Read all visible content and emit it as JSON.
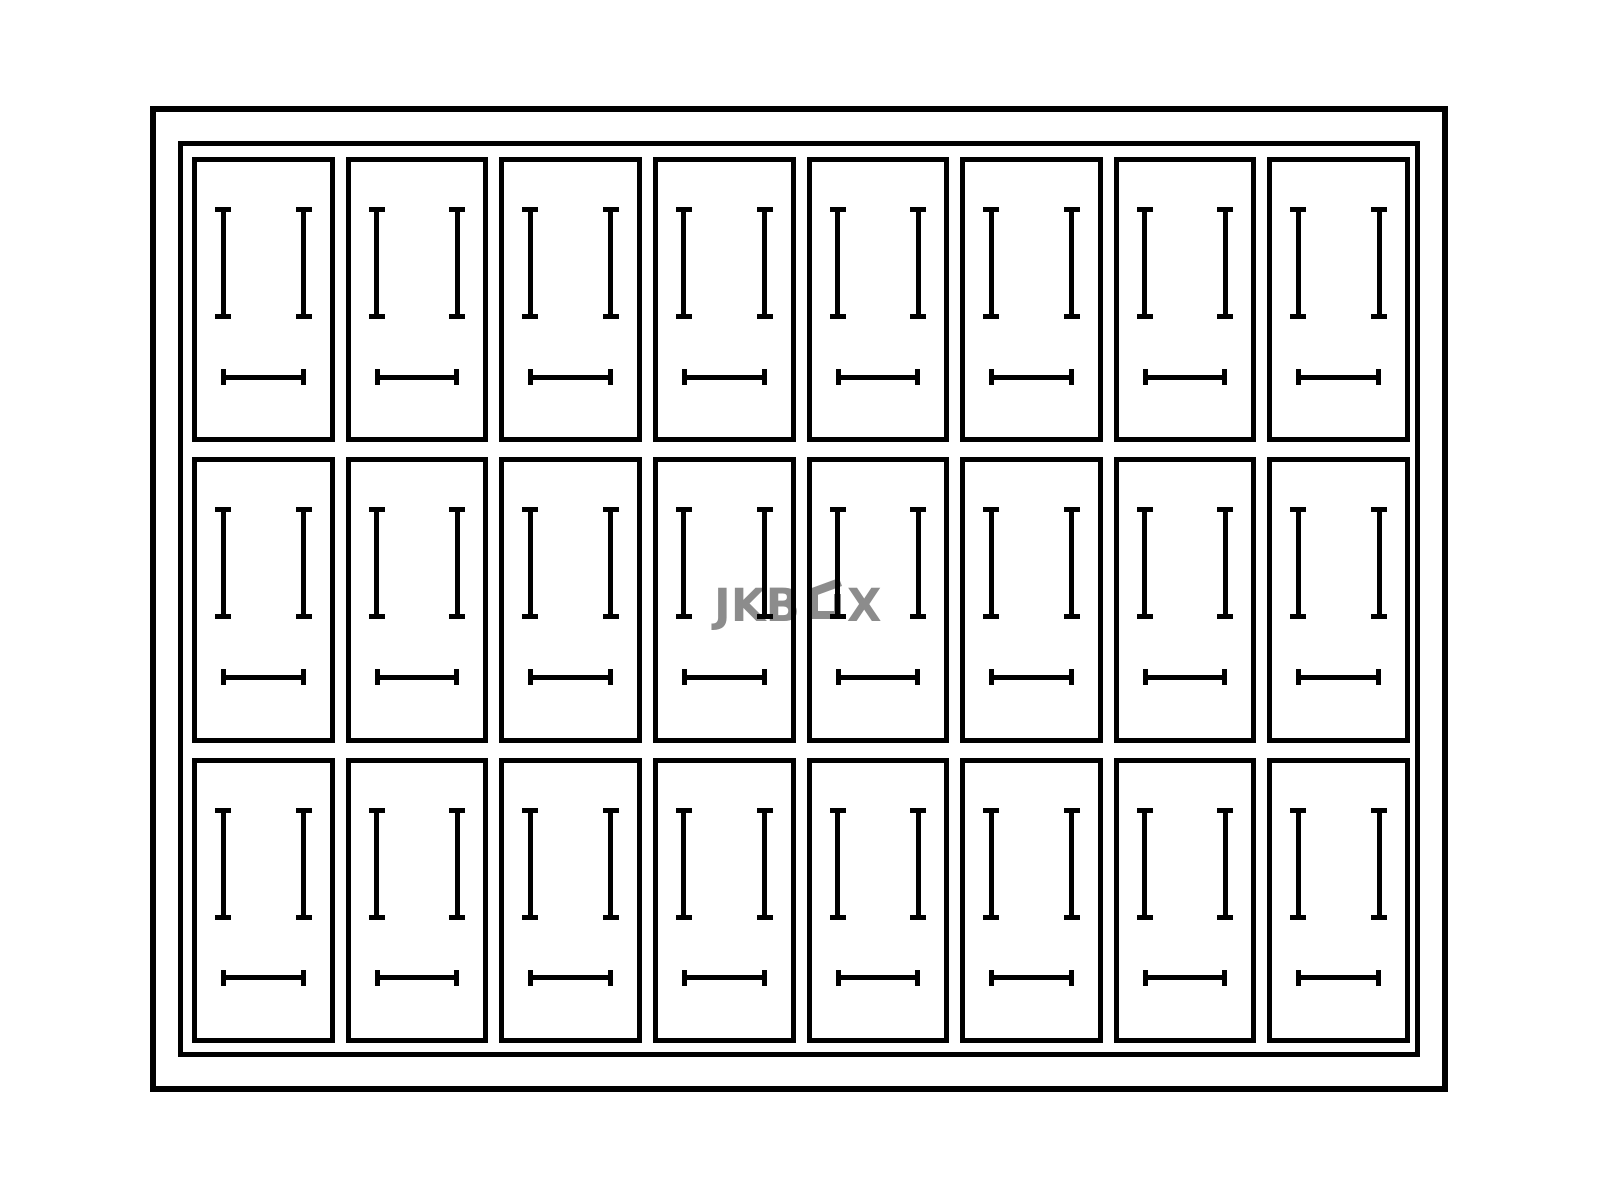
{
  "diagram": {
    "kind": "jewelry-tray-top-view",
    "background_color": "#ffffff",
    "line_color": "#000000",
    "grid": {
      "rows": 3,
      "columns": 8,
      "compartment_count": 24
    },
    "compartment": {
      "vertical_pins": 2,
      "horizontal_bars": 1
    }
  },
  "watermark": {
    "text": "JKBOX",
    "part1": "JKB",
    "part2": "X",
    "color": "#8c8c8c"
  }
}
